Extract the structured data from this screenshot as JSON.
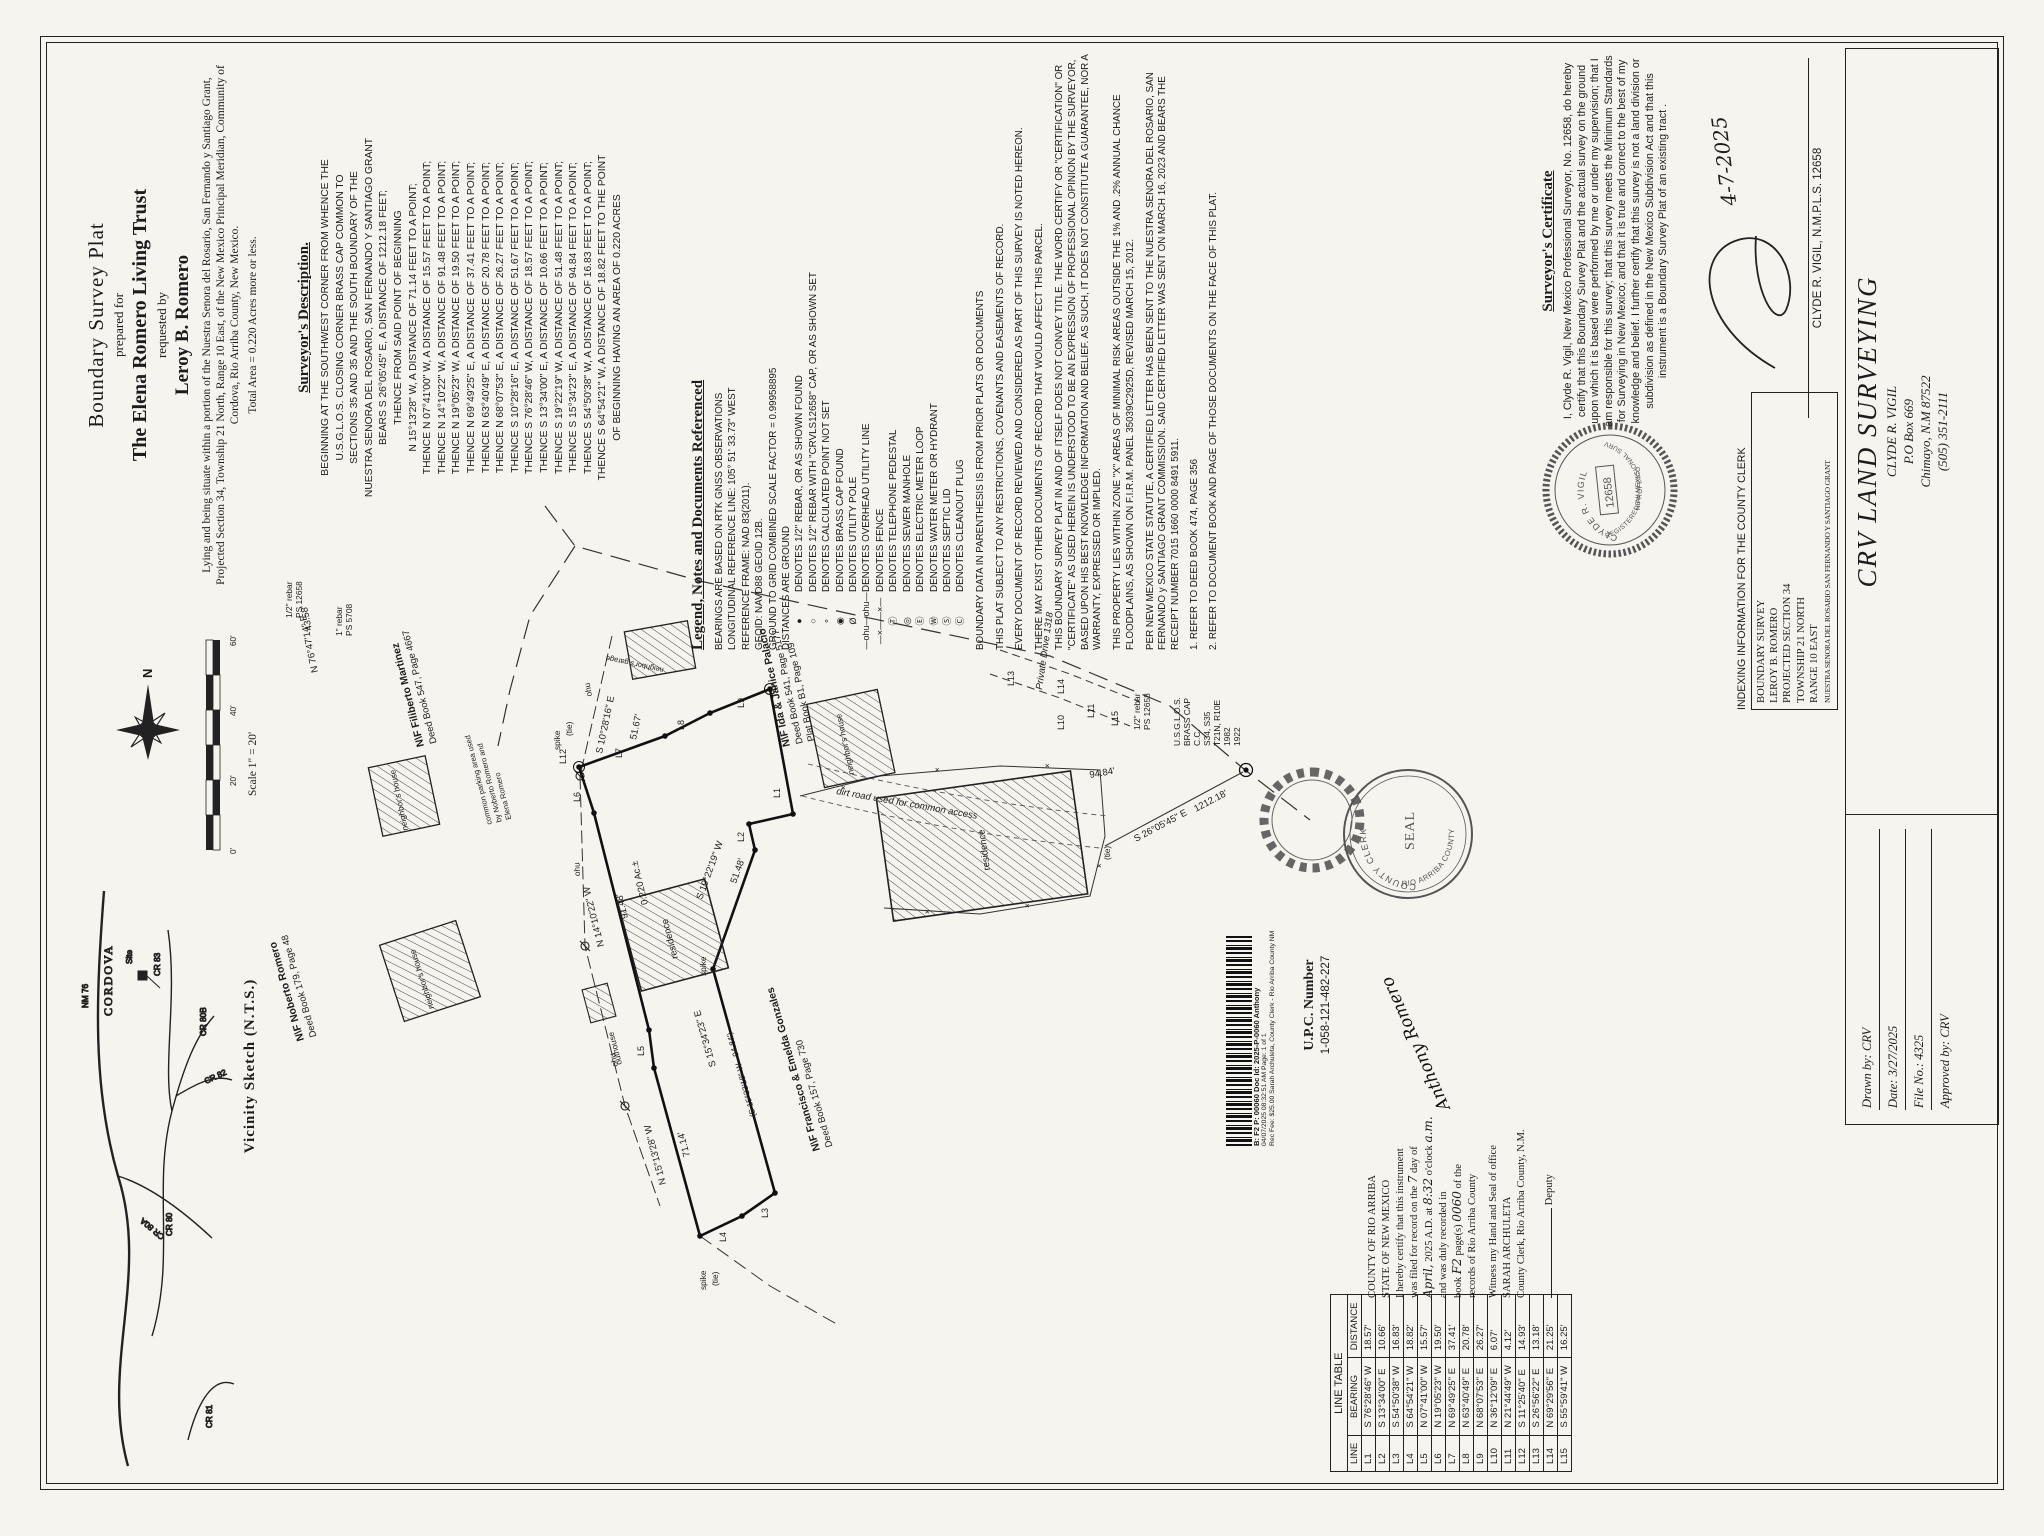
{
  "title_block": {
    "line1": "Boundary Survey Plat",
    "line2": "prepared for",
    "line3": "The Elena Romero Living Trust",
    "line4": "requested by",
    "line5": "Leroy B. Romero",
    "situate": "Lying and being situate within a portion of the Nuestra Senora del Rosario, San Fernando y Santiago Grant, Projected Section 34, Township 21 North, Range 10 East, of the New Mexico Principal Meridian, Community of Cordova, Rio Arriba County, New Mexico.",
    "total_area": "Total Area = 0.220 Acres more or less."
  },
  "description": {
    "heading": "Surveyor's Description.",
    "intro": [
      "BEGINNING AT THE SOUTHWEST CORNER FROM WHENCE THE",
      "U.S.G.L.O.S. CLOSING CORNER BRASS CAP COMMON TO",
      "SECTIONS 35 AND 35 AND THE SOUTH BOUNDARY OF THE",
      "NUESTRA SENORA DEL ROSARIO, SAN FERNANDO Y SANTIAGO GRANT",
      "BEARS S 26°05'45\" E, A DISTANCE OF 1212.18 FEET;",
      "THENCE FROM SAID POINT OF BEGINNING"
    ],
    "courses": [
      "N 15°13'28\" W, A DISTANCE OF 71.14 FEET TO A POINT;",
      "THENCE N 07°41'00\" W, A DISTANCE OF 15.57 FEET TO A POINT;",
      "THENCE N 14°10'22\" W, A DISTANCE OF 91.48 FEET TO A POINT;",
      "THENCE N 19°05'23\" W, A DISTANCE OF 19.50 FEET TO A POINT;",
      "THENCE N 69°49'25\" E, A DISTANCE OF 37.41 FEET TO A POINT;",
      "THENCE N 63°40'49\" E, A DISTANCE OF 20.78 FEET TO A POINT;",
      "THENCE N 68°07'53\" E, A DISTANCE OF 26.27 FEET TO A POINT;",
      "THENCE S 10°28'16\" E, A DISTANCE OF 51.67 FEET TO A POINT;",
      "THENCE S 76°28'46\" W, A DISTANCE OF 18.57 FEET TO A POINT;",
      "THENCE S 13°34'00\" E, A DISTANCE OF 10.66 FEET TO A POINT;",
      "THENCE S 19°22'19\" W, A DISTANCE OF 51.48 FEET TO A POINT;",
      "THENCE S 15°34'23\" E, A DISTANCE OF 94.84 FEET TO A POINT;",
      "THENCE S 54°50'38\" W, A DISTANCE OF 16.83 FEET TO A POINT;",
      "THENCE S 64°54'21\" W, A DISTANCE OF 18.82 FEET TO THE POINT",
      "OF BEGINNING HAVING AN AREA OF 0.220 ACRES"
    ]
  },
  "legend": {
    "heading": "Legend, Notes and Documents Referenced",
    "notes_top": [
      "BEARINGS ARE BASED ON RTK GNSS OBSERVATIONS",
      "LONGITUDINAL REFERENCE LINE: 105° 51' 33.73\" WEST",
      "REFERENCE FRAME: NAD 83(2011).",
      "GEOID: NAVD88 GEOID 12B.",
      "GROUND TO GRID COMBINED SCALE FACTOR = 0.99958895",
      "DISTANCES ARE GROUND"
    ],
    "items": [
      {
        "sym": "●",
        "text": "DENOTES 1/2\" REBAR, OR AS SHOWN FOUND"
      },
      {
        "sym": "○",
        "text": "DENOTES 1/2\" REBAR WITH \"CRVLS12658\" CAP, OR AS SHOWN SET"
      },
      {
        "sym": "∘",
        "text": "DENOTES CALCULATED POINT NOT SET"
      },
      {
        "sym": "◉",
        "text": "DENOTES BRASS CAP FOUND"
      },
      {
        "sym": "Ø",
        "text": "DENOTES UTILITY POLE"
      },
      {
        "sym": "—ohu—ohu—",
        "text": "DENOTES OVERHEAD UTILITY LINE"
      },
      {
        "sym": "—×——×—",
        "text": "DENOTES FENCE"
      },
      {
        "sym": "Ⓣ",
        "text": "DENOTES TELEPHONE PEDESTAL"
      },
      {
        "sym": "◎",
        "text": "DENOTES SEWER MANHOLE"
      },
      {
        "sym": "Ⓔ",
        "text": "DENOTES ELECTRIC METER LOOP"
      },
      {
        "sym": "Ⓦ",
        "text": "DENOTES WATER METER OR HYDRANT"
      },
      {
        "sym": "Ⓢ",
        "text": "DENOTES SEPTIC LID"
      },
      {
        "sym": "Ⓒ",
        "text": "DENOTES CLEANOUT PLUG"
      }
    ],
    "paragraphs": [
      "BOUNDARY DATA IN PARENTHESIS IS FROM PRIOR PLATS OR DOCUMENTS",
      "THIS PLAT SUBJECT TO ANY RESTRICTIONS, COVENANTS AND EASEMENTS OF RECORD.",
      "EVERY DOCUMENT OF RECORD REVIEWED AND CONSIDERED AS PART OF THIS SURVEY IS NOTED HEREON.",
      "THERE MAY EXIST OTHER DOCUMENTS OF RECORD THAT WOULD AFFECT THIS PARCEL.",
      "THIS BOUNDARY SURVEY PLAT IN AND OF ITSELF DOES NOT CONVEY TITLE. THE WORD CERTIFY OR \"CERTIFICATION\" OR \"CERTIFICATE\" AS USED HEREIN IS UNDERSTOOD TO BE AN EXPRESSION OF PROFESSIONAL OPINION BY THE SURVEYOR, BASED UPON HIS BEST KNOWLEDGE INFORMATION AND BELIEF. AS SUCH, IT DOES NOT CONSTITUTE A GUARANTEE, NOR A WARRANTY, EXPRESSED OR IMPLIED.",
      "THIS PROPERTY LIES WITHIN ZONE \"X\" AREAS OF MINIMAL RISK AREAS OUTSIDE THE 1% AND .2% ANNUAL CHANCE FLOODPLAINS, AS SHOWN ON F.I.R.M. PANEL 35039C2925D, REVISED MARCH 15, 2012.",
      "PER NEW MEXICO STATE STATUTE, A CERTIFIED LETTER HAS BEEN SENT TO THE NUESTRA SENORA DEL ROSARIO, SAN FERNANDO y SANTIAGO GRANT COMMISSION. SAID CERTIFIED LETTER WAS SENT ON MARCH 16, 2023 AND BEARS THE RECEIPT NUMBER 7015 1660 0000 8491 5911."
    ],
    "refs": [
      "1.   REFER TO DEED BOOK 474, PAGE 356",
      "2.   REFER TO DOCUMENT BOOK AND PAGE OF THOSE DOCUMENTS ON THE FACE OF THIS PLAT."
    ]
  },
  "certificate": {
    "heading": "Surveyor's Certificate",
    "body": "I, Clyde R. Vigil, New Mexico Professional Surveyor, No. 12658, do hereby certify that this Boundary Survey Plat and the actual survey on the ground upon which it is based were performed by me or under my supervision; that I am responsible for this survey; that this survey meets the Minimum Standards for Surveying in New Mexico; and that it is  true and correct to the best of my knowledge and belief. I further certify that this survey is not a land division or subdivision as defined in the New Mexico Subdivision Act and that this instrument is a Boundary Survey Plat of an existing tract .",
    "signer": "CLYDE R. VIGIL, N.M.P.L.S. 12658",
    "signature_date": "4-7-2025",
    "seal_name": "CLYDE R. VIGIL",
    "seal_ring": "REGISTERED PROFESSIONAL SURVEYOR",
    "seal_state": "NEW MEXICO",
    "seal_number": "12658"
  },
  "indexing": {
    "heading": "INDEXING INFORMATION FOR THE COUNTY CLERK",
    "lines": [
      "BOUNDARY SURVEY",
      "LEROY B. ROMERO",
      "PROJECTED SECTION 34",
      "TOWNSHIP 21 NORTH",
      "RANGE 10 EAST",
      "NUESTRA SENORA DEL ROSARIO SAN FERNANDO Y SANTIAGO GRANT"
    ]
  },
  "firm_block": {
    "company": "CRV LAND SURVEYING",
    "name": "CLYDE R. VIGIL",
    "address1": "P.O Box 669",
    "address2": "Chimayo, N.M 87522",
    "phone": "(505) 351-2111",
    "drawn_by": "Drawn by: CRV",
    "date": "Date: 3/27/2025",
    "file_no": "File No.: 4325",
    "approved_by": "Approved by: CRV"
  },
  "recording": {
    "l1": "COUNTY OF RIO ARRIBA",
    "l2": "STATE OF NEW MEXICO",
    "l3": "I hereby certify that this instrument",
    "l4a": "was filed for record on the",
    "l4b": "7",
    "l4c": "day of",
    "l5a": "April,",
    "l5b": "2025 A.D. at",
    "l5c": "8:32",
    "l5d": "o'clock",
    "l5e": "a.m.",
    "l6": "and was duly recorded in",
    "l7a": "book",
    "l7b": "F2",
    "l7c": "page(s)",
    "l7d": "0060",
    "l7e": "of the",
    "l8": "records of Rio Arriba County",
    "l9": "Witness my Hand and Seal of office",
    "l10": "SARAH ARCHULETA",
    "l11": "County Clerk, Rio Arriba County, N.M.",
    "deputy_label": "Deputy",
    "signature": "Anthony Romero"
  },
  "upc": {
    "label": "U.P.C. Number",
    "value": "1-058-121-482-227"
  },
  "stamp": {
    "line1": "B: F2 P: 00060 Doc Id: 2025-P-0060 Anthony",
    "line2": "04/07/2025 08:32:51 AM Page: 1 of 1",
    "line3": "Rec Fee: $25.00 Sarah Archuleta, County Clerk - Rio Arriba County NM"
  },
  "county_seal": {
    "top": "COUNTY CLERK",
    "bottom": "RIO ARRIBA COUNTY",
    "center": "SEAL"
  },
  "compass": {
    "north": "N"
  },
  "scale": {
    "ticks": [
      "0'",
      "20'",
      "40'",
      "60'"
    ],
    "label": "Scale 1\" = 20'"
  },
  "vicinity": {
    "caption": "Vicinity Sketch (N.T.S.)",
    "town": "CORDOVA",
    "site": "Site",
    "roads": [
      "NM 76",
      "CR 80A",
      "CR 80",
      "CR 80B",
      "CR 82",
      "CR 83",
      "CR 81"
    ]
  },
  "map": {
    "owners": [
      [
        "N\\F Filiberto Martinez",
        "Deed Book 547, Page 4667"
      ],
      [
        "N\\F Ida & Janice Palacio",
        "Deed Book 541, Page 5177",
        "Plat Book B1, Page 109"
      ],
      [
        "N\\F Noberto Romero",
        "Deed Book 179, Page 48"
      ],
      [
        "N\\F Francisco & Emelda Gonzales",
        "Deed Book 157, Page 730"
      ]
    ],
    "t": {
      "pd": "Private Drive 1318",
      "dirt": "dirt road used for common access",
      "cp1": "common parking area used",
      "cp2": "by Noberto Romero and",
      "cp3": "Elena Romero",
      "area": "0.220 Ac.±",
      "res": "residence",
      "nh": "neighbor's house",
      "ng": "neighbor's garage",
      "oh": "outhouse",
      "spike": "spike",
      "tie": "(tie)",
      "b1": "S 10°28'16\" E",
      "d1": "51.67'",
      "b2": "S 19°22'19\" W",
      "d2": "51.48'",
      "b3": "S 15°34'23\" E",
      "p3": "(S 15°33'18\" W - 94.84')",
      "d3": "94.84'",
      "b4": "N 15°13'28\" W",
      "d4": "71.14'",
      "b5": "N 14°10'22\" W",
      "d5": "91.48'",
      "b6": "N 76°47'14\" E",
      "d6": "43.58'",
      "tieb": "S 26°05'45\" E",
      "tied": "1212.18'",
      "ohu": "ohu",
      "reb1a": "1/2\" rebar",
      "reb1b": "PS 12658",
      "reb2a": "1\" rebar",
      "reb2b": "PS 5708",
      "cap": [
        "U.S.G.L.O.S.",
        "BRASS CAP",
        "C.C.",
        "S34, S35",
        "T21N, R10E",
        "1982",
        "1922"
      ]
    },
    "L": [
      "L1",
      "L2",
      "L3",
      "L4",
      "L5",
      "L6",
      "L7",
      "L8",
      "L9",
      "L10",
      "L11",
      "L12",
      "L13",
      "L14",
      "L15"
    ]
  },
  "line_table": {
    "title": "LINE TABLE",
    "headers": [
      "LINE",
      "BEARING",
      "DISTANCE"
    ],
    "rows": [
      {
        "line": "L1",
        "bearing": "S 76°28'46\" W",
        "distance": "18.57'"
      },
      {
        "line": "L2",
        "bearing": "S 13°34'00\" E",
        "distance": "10.66'"
      },
      {
        "line": "L3",
        "bearing": "S 54°50'38\" W",
        "distance": "16.83'"
      },
      {
        "line": "L4",
        "bearing": "S 64°54'21\" W",
        "distance": "18.82'"
      },
      {
        "line": "L5",
        "bearing": "N 07°41'00\" W",
        "distance": "15.57'"
      },
      {
        "line": "L6",
        "bearing": "N 19°05'23\" W",
        "distance": "19.50'"
      },
      {
        "line": "L7",
        "bearing": "N 69°49'25\" E",
        "distance": "37.41'"
      },
      {
        "line": "L8",
        "bearing": "N 63°40'49\" E",
        "distance": "20.78'"
      },
      {
        "line": "L9",
        "bearing": "N 68°07'53\" E",
        "distance": "26.27'"
      },
      {
        "line": "L10",
        "bearing": "N 36°12'09\" E",
        "distance": "6.07'"
      },
      {
        "line": "L11",
        "bearing": "N 21°44'49\" W",
        "distance": "4.12'"
      },
      {
        "line": "L12",
        "bearing": "S 11°25'40\" E",
        "distance": "14.93'"
      },
      {
        "line": "L13",
        "bearing": "S 26°56'22\" E",
        "distance": "13.18'"
      },
      {
        "line": "L14",
        "bearing": "N 69°29'56\" E",
        "distance": "21.25'"
      },
      {
        "line": "L15",
        "bearing": "S 55°59'41\" W",
        "distance": "16.25'"
      }
    ]
  }
}
